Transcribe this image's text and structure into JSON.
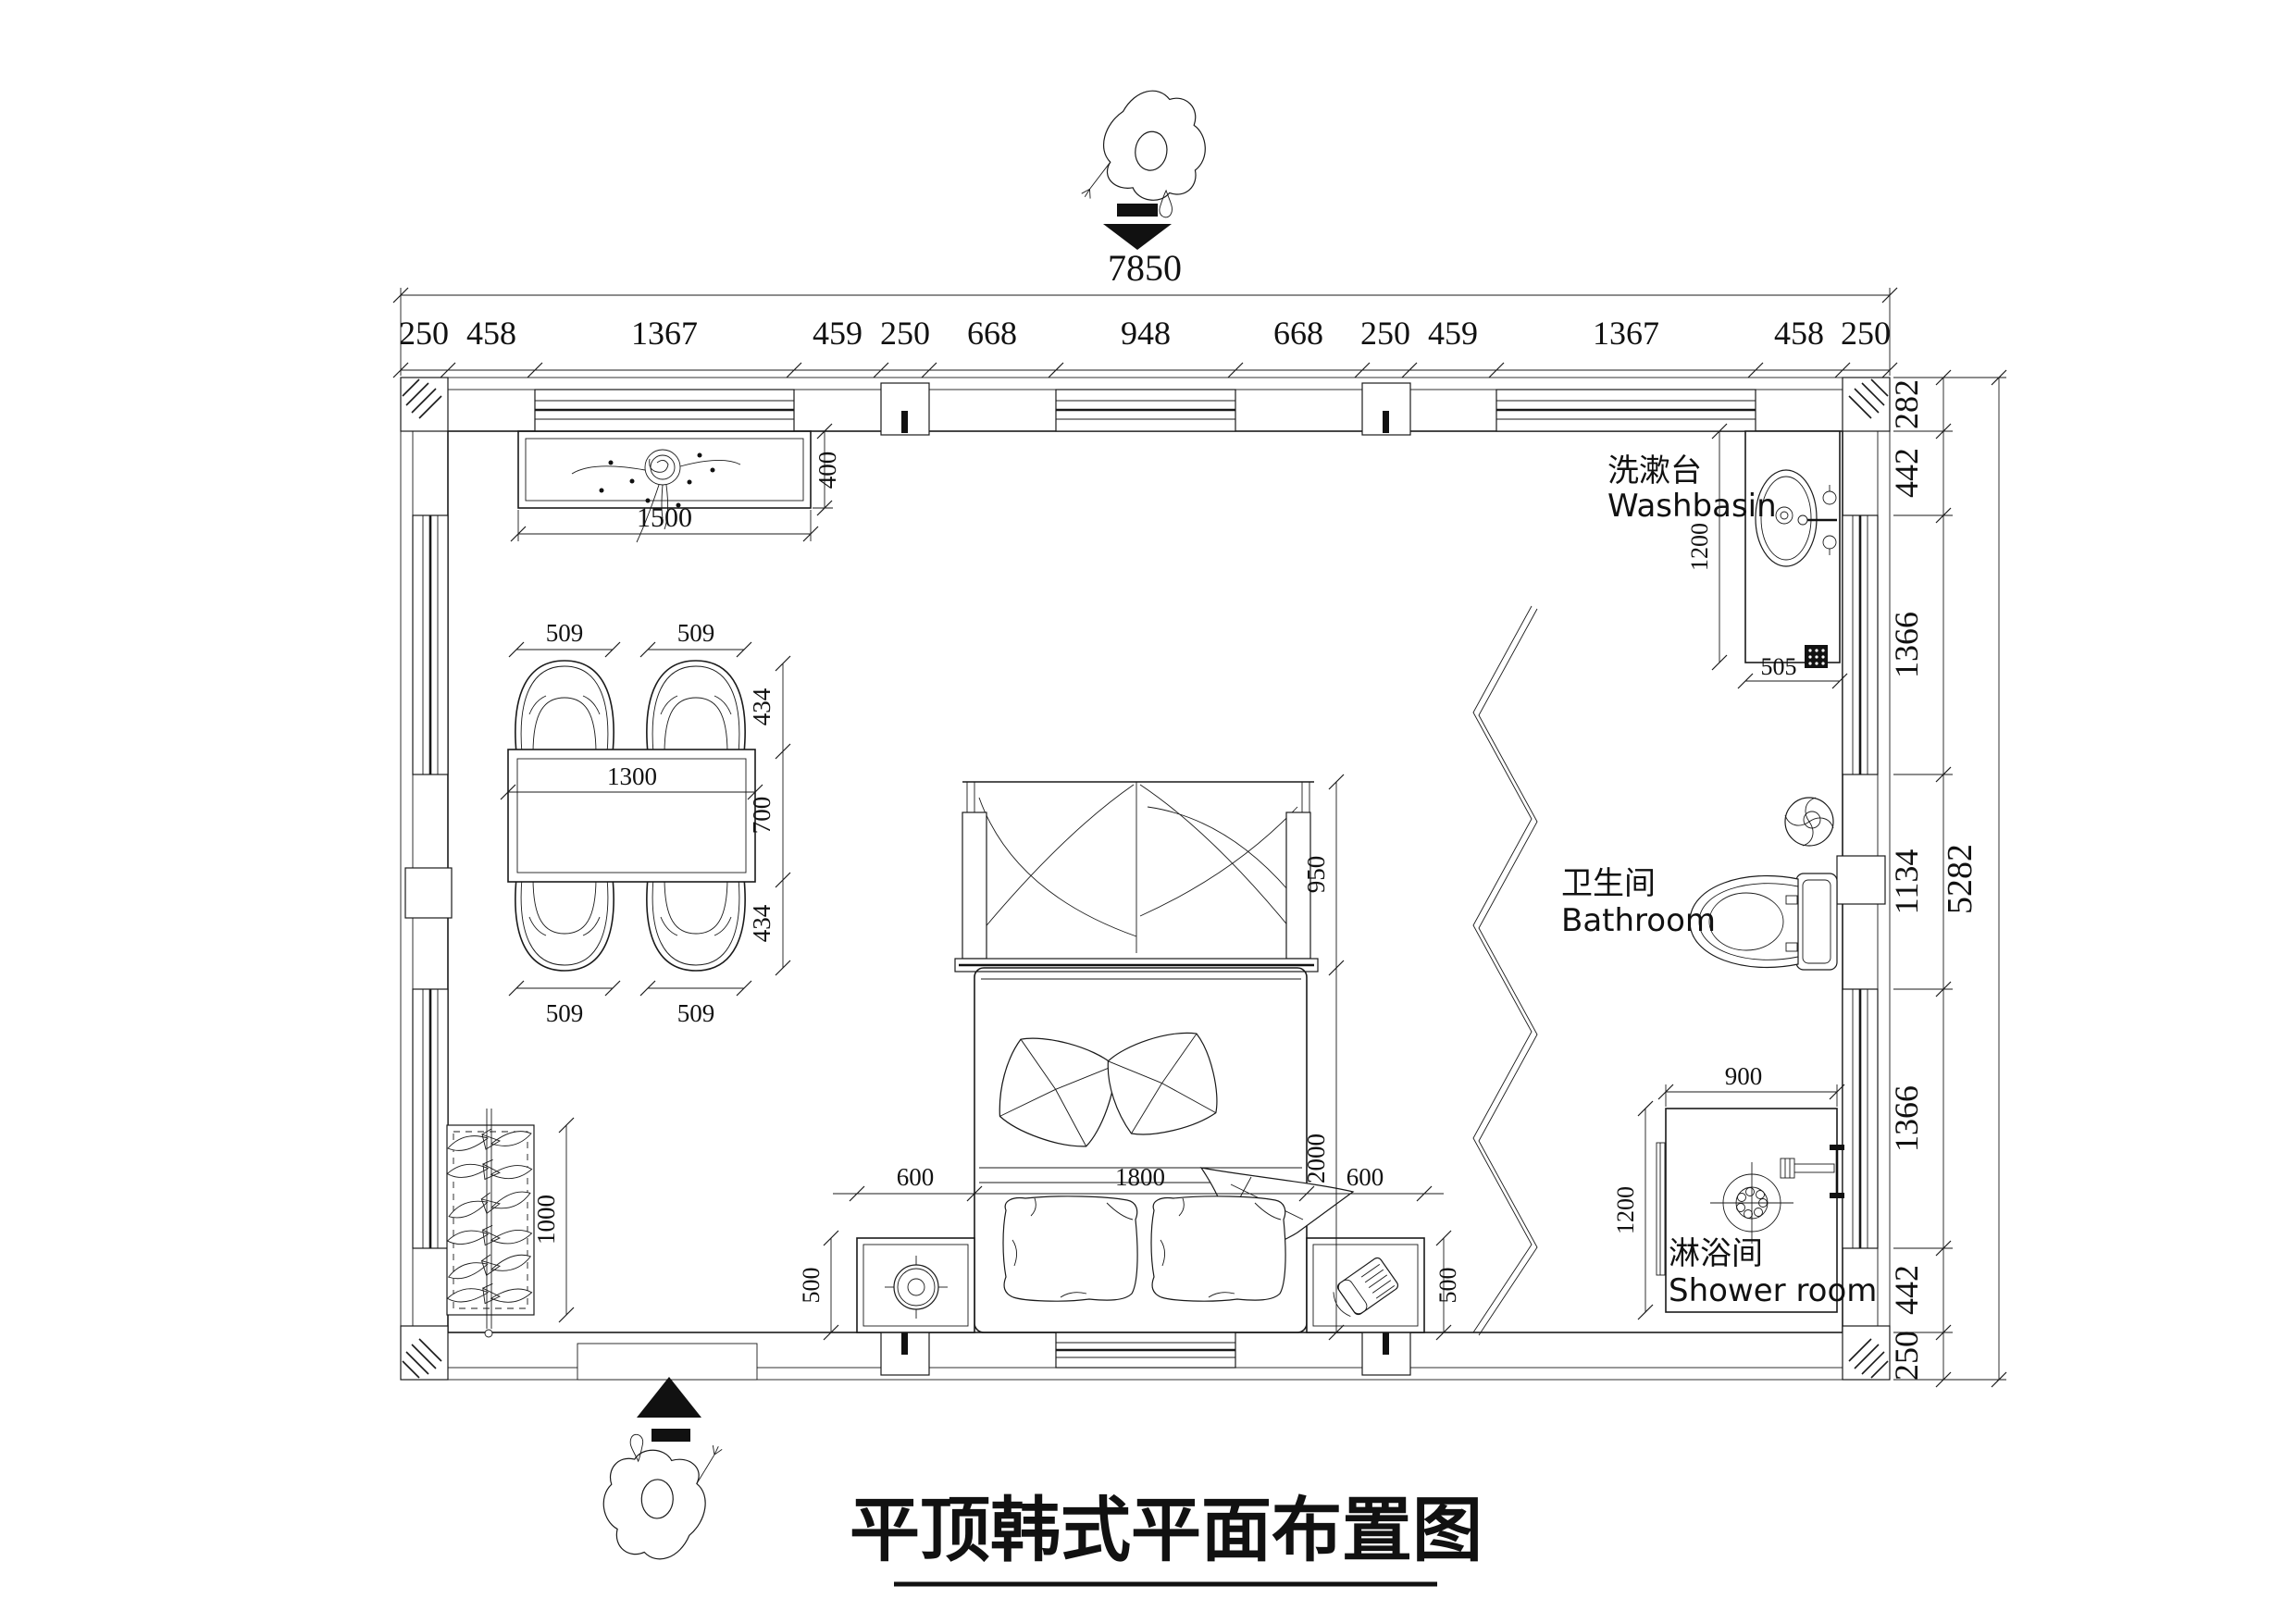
{
  "title": {
    "text": "平顶韩式平面布置图"
  },
  "dims": {
    "top": {
      "total": "7850",
      "segments": [
        "250",
        "458",
        "1367",
        "459",
        "250",
        "668",
        "948",
        "668",
        "250",
        "459",
        "1367",
        "458",
        "250"
      ]
    },
    "right": {
      "total": "5282",
      "segments": [
        "282",
        "442",
        "1366",
        "1134",
        "1366",
        "442",
        "250"
      ]
    }
  },
  "labels": {
    "washbasin_zh": "洗漱台",
    "washbasin_en": "Washbasin",
    "bathroom_zh": "卫生间",
    "bathroom_en": "Bathroom",
    "shower_zh": "淋浴间",
    "shower_en": "Shower room"
  },
  "furniture_dims": {
    "console_w": "1500",
    "console_d": "400",
    "table_w": "1300",
    "table_d": "700",
    "chair_w": "509",
    "chair_d": "434",
    "rack_l": "1000",
    "canopy_d": "950",
    "bed_l": "2000",
    "bed_w": "1800",
    "side_w": "600",
    "nightstand_d": "500",
    "basin_counter_d": "1200",
    "basin_counter_w": "505",
    "shower_w": "900",
    "shower_d": "1200"
  }
}
